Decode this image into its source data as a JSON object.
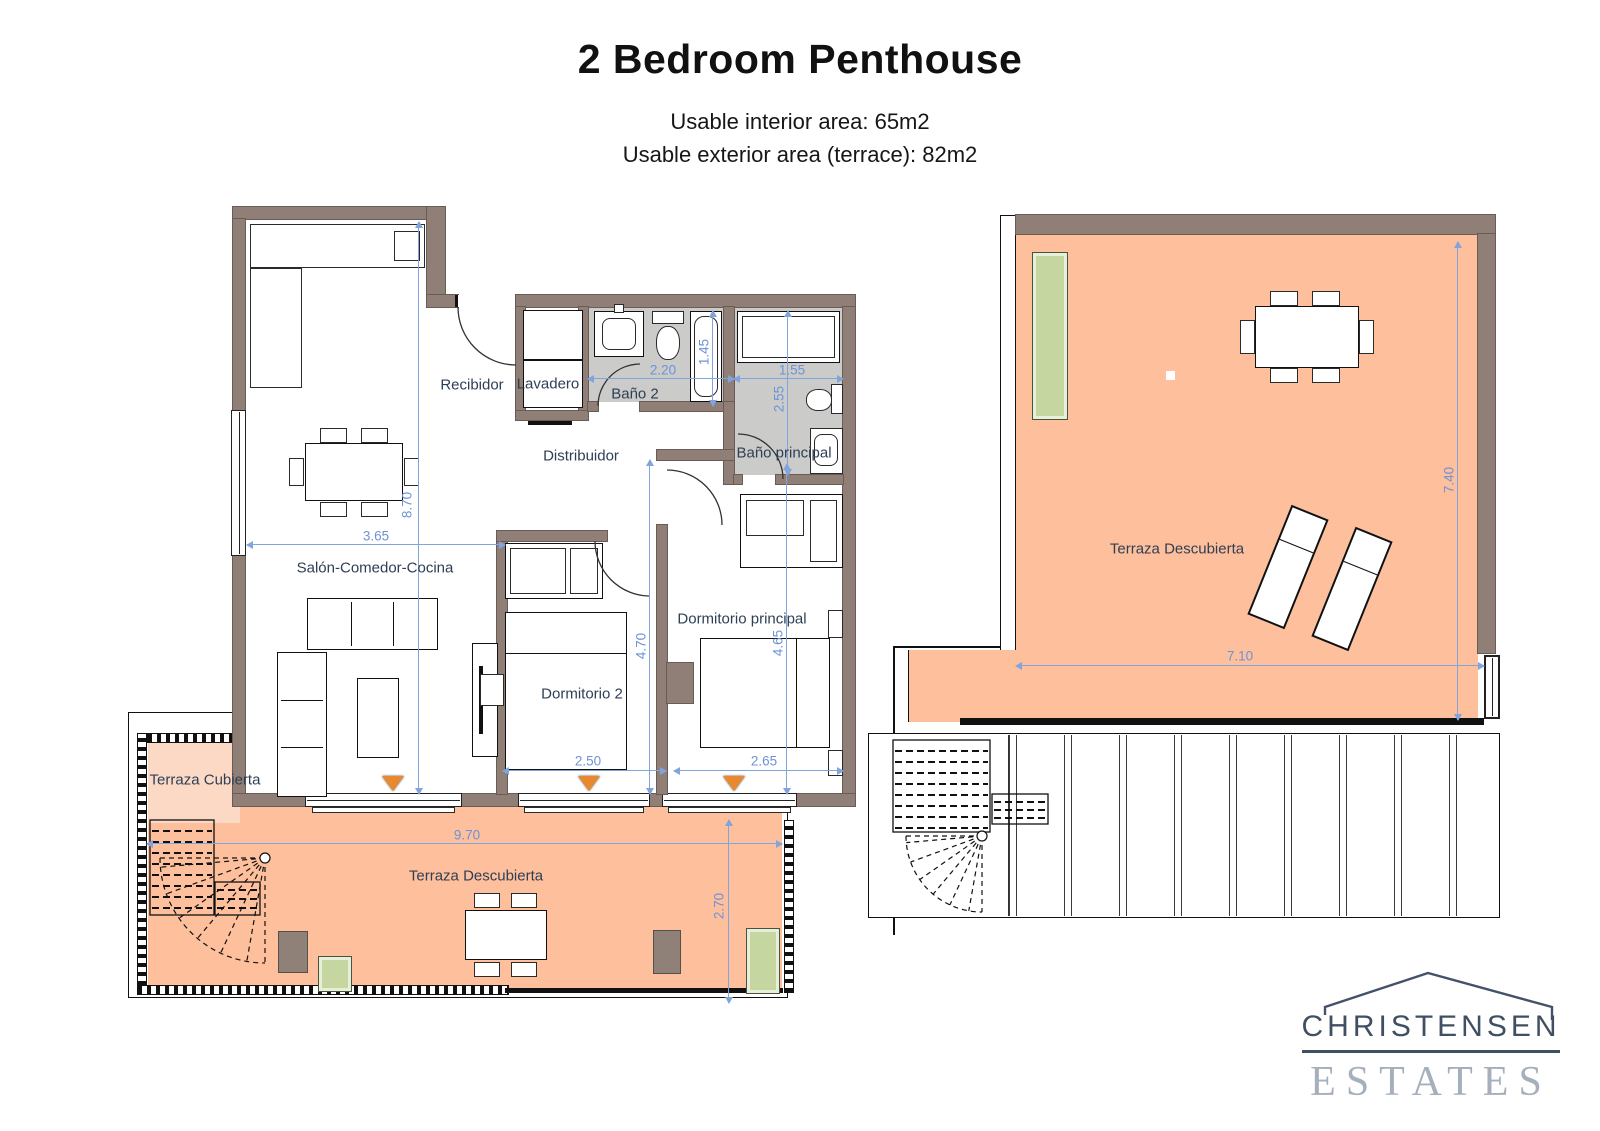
{
  "header": {
    "title": "2 Bedroom Penthouse",
    "interior_area": "Usable interior area: 65m2",
    "exterior_area": "Usable exterior area (terrace): 82m2"
  },
  "unit_plan": {
    "rooms": {
      "recibidor": "Recibidor",
      "lavadero": "Lavadero",
      "bano2": "Baño 2",
      "distribuidor": "Distribuidor",
      "bano_principal": "Baño principal",
      "salon_comedor_cocina": "Salón-Comedor-Cocina",
      "dormitorio2": "Dormitorio 2",
      "dormitorio_principal": "Dormitorio principal",
      "terraza_cubierta": "Terraza Cubierta",
      "terraza_descubierta": "Terraza Descubierta"
    },
    "dimensions_m": {
      "bano2_width": "2.20",
      "bano2_tub_length": "1.45",
      "bano_principal_width": "1.55",
      "bano_principal_depth": "2.55",
      "unit_depth": "8.70",
      "salon_width": "3.65",
      "dormitorio2_depth": "4.70",
      "dormitorio_principal_depth": "4.65",
      "dormitorio2_width": "2.50",
      "dormitorio_principal_width": "2.65",
      "terraza_width": "9.70",
      "terraza_depth": "2.70"
    }
  },
  "roof_plan": {
    "terraza_descubierta": "Terraza Descubierta",
    "dimensions_m": {
      "depth": "7.40",
      "width": "7.10"
    }
  },
  "logo": {
    "name": "CHRISTENSEN",
    "word": "ESTATES"
  },
  "colors": {
    "wall": "#8f7f77",
    "terrace_open": "#febf9c",
    "terrace_covered": "#fbd9c5",
    "bath_floor": "#cbcbca",
    "planter_green": "#c5d6a0",
    "planter_brown": "#8f8178",
    "dimension_blue": "#6d93d6",
    "window_marker_orange": "#e8892f",
    "logo_dark": "#414f63",
    "logo_light": "#a6b0bd"
  }
}
